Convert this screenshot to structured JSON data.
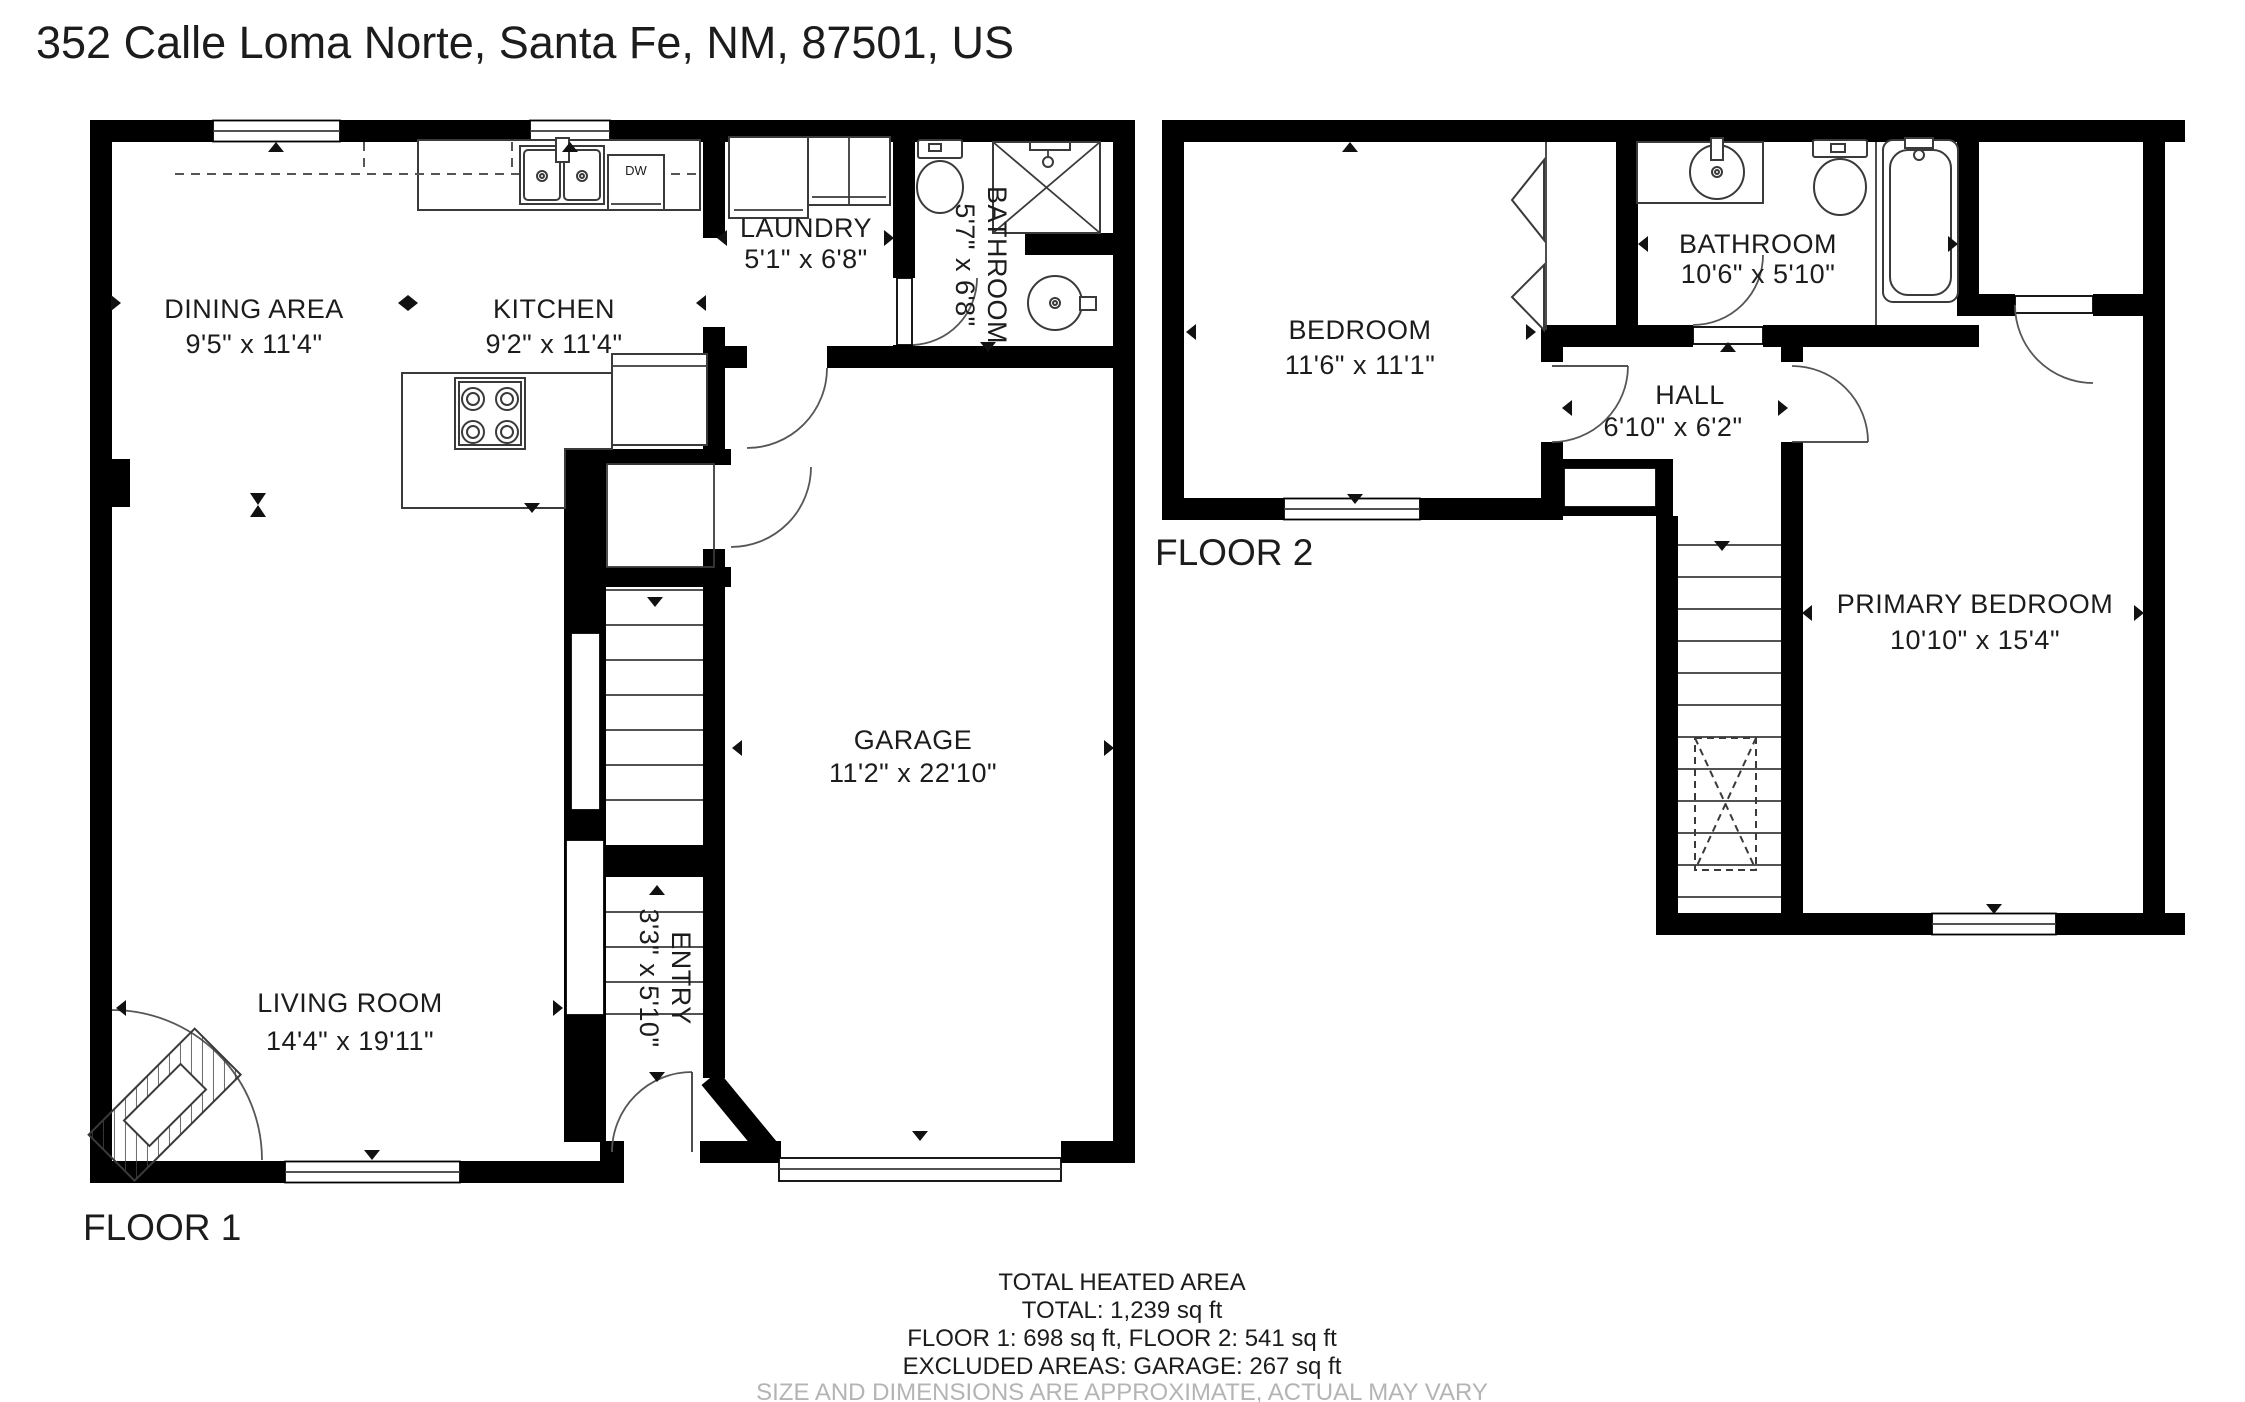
{
  "title": "352 Calle Loma Norte, Santa Fe, NM, 87501, US",
  "floor1": {
    "label": "FLOOR 1",
    "rooms": {
      "dining": {
        "name": "DINING AREA",
        "dims": "9'5\" x 11'4\""
      },
      "kitchen": {
        "name": "KITCHEN",
        "dims": "9'2\" x 11'4\""
      },
      "laundry": {
        "name": "LAUNDRY",
        "dims": "5'1\" x 6'8\""
      },
      "bathroom": {
        "name": "BATHROOM",
        "dims": "5'7\" x 6'8\""
      },
      "living": {
        "name": "LIVING ROOM",
        "dims": "14'4\" x 19'11\""
      },
      "garage": {
        "name": "GARAGE",
        "dims": "11'2\" x 22'10\""
      },
      "entry": {
        "name": "ENTRY",
        "dims": "3'3\" x 5'10\""
      }
    },
    "appliances": {
      "dishwasher": "DW"
    }
  },
  "floor2": {
    "label": "FLOOR 2",
    "rooms": {
      "bedroom": {
        "name": "BEDROOM",
        "dims": "11'6\" x 11'1\""
      },
      "bathroom": {
        "name": "BATHROOM",
        "dims": "10'6\" x 5'10\""
      },
      "hall": {
        "name": "HALL",
        "dims": "6'10\" x 6'2\""
      },
      "primary": {
        "name": "PRIMARY BEDROOM",
        "dims": "10'10\" x 15'4\""
      }
    }
  },
  "footer": {
    "line1": "TOTAL HEATED AREA",
    "line2": "TOTAL: 1,239 sq ft",
    "line3": "FLOOR 1: 698 sq ft, FLOOR 2: 541 sq ft",
    "line4": "EXCLUDED AREAS: GARAGE: 267 sq ft",
    "disclaimer": "SIZE AND DIMENSIONS ARE APPROXIMATE, ACTUAL MAY VARY"
  },
  "colors": {
    "wall": "#000000",
    "background": "#ffffff",
    "fixture": "#3a3a3a",
    "text": "#1c1c1c",
    "muted": "#b4b4b4"
  }
}
